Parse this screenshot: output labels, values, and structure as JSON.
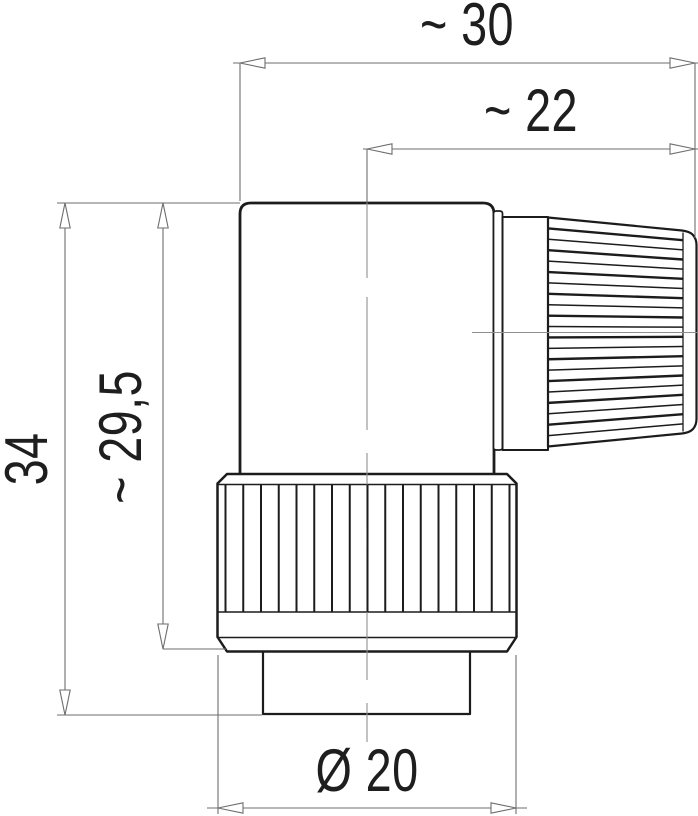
{
  "drawing": {
    "kind": "dimension-drawing",
    "view": "right-angle-connector-side-view",
    "dimensions": {
      "overall_width": {
        "label": "~ 30"
      },
      "axis_to_cable_end": {
        "label": "~ 22"
      },
      "overall_height": {
        "label": "34"
      },
      "height_to_coupling_ring": {
        "label": "~ 29,5"
      },
      "coupling_ring_diameter": {
        "label": "Ø 20"
      }
    },
    "colors": {
      "background": "#ffffff",
      "outline": "#1c1c1c",
      "dimension_line": "#6e6e6e",
      "centerline": "#8f8f8f",
      "text": "#1e1e1e"
    }
  }
}
